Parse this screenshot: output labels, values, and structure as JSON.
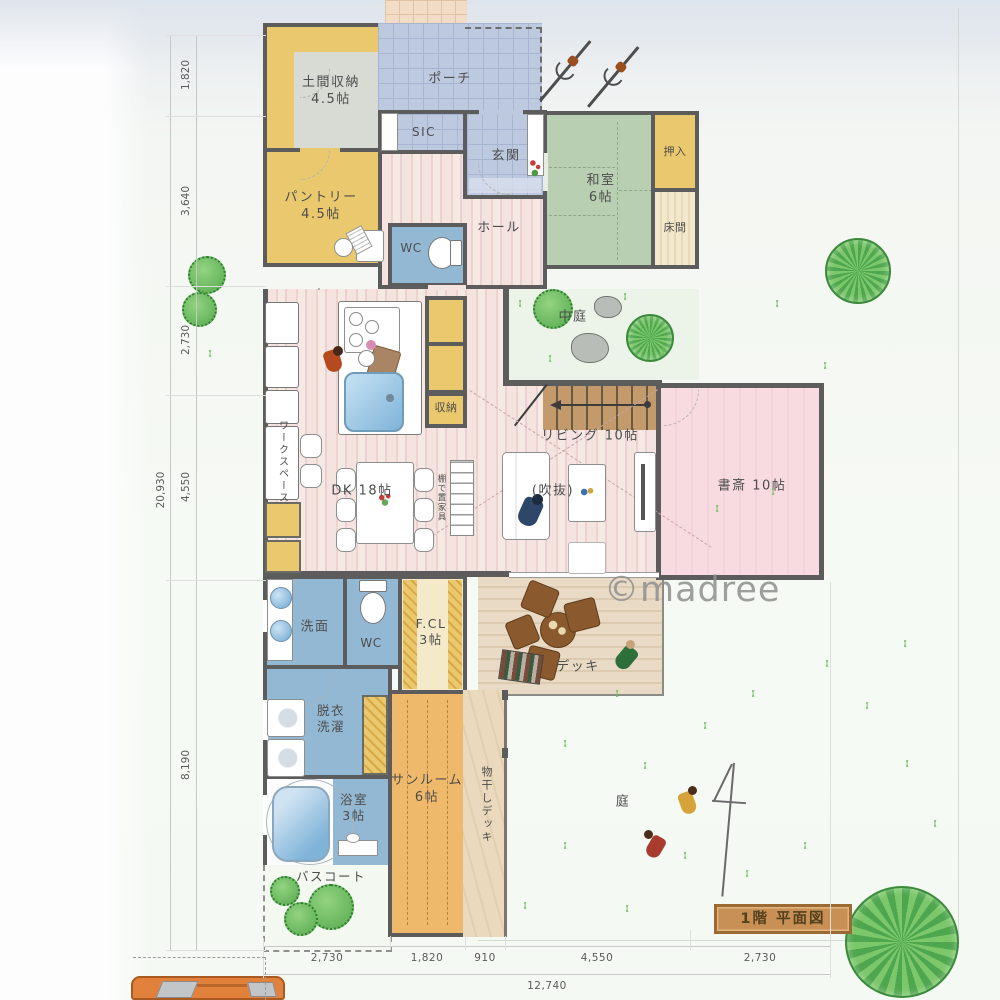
{
  "watermark": {
    "text": "©madree"
  },
  "sign": {
    "label": "1階 平面図"
  },
  "rooms": {
    "doma": {
      "label": "土間収納",
      "size": "4.5帖"
    },
    "pantry": {
      "label": "パントリー",
      "size": "4.5帖"
    },
    "porch": {
      "label": "ポーチ"
    },
    "sic": {
      "label": "SIC"
    },
    "genkan": {
      "label": "玄関"
    },
    "hall": {
      "label": "ホール"
    },
    "wc_upper": {
      "label": "WC"
    },
    "washitsu": {
      "label": "和室",
      "size": "6帖"
    },
    "oshiire": {
      "label": "押入"
    },
    "tokonoma": {
      "label": "床間"
    },
    "nakaniwa": {
      "label": "中庭"
    },
    "dk": {
      "label": "DK 18帖"
    },
    "shuno": {
      "label": "収納"
    },
    "workspace": {
      "label": "ワークスペース"
    },
    "living": {
      "label": "リビング 10帖"
    },
    "fukinuke": {
      "label": "(吹抜)"
    },
    "shelf_note": {
      "label": "棚で置家具"
    },
    "shosai": {
      "label": "書斎 10帖"
    },
    "senmen": {
      "label": "洗面"
    },
    "wc_lower": {
      "label": "WC"
    },
    "fcl": {
      "label": "F.CL",
      "size": "3帖"
    },
    "datsui_sentaku": {
      "label": "脱衣洗濯"
    },
    "sunroom": {
      "label": "サンルーム",
      "size": "6帖"
    },
    "monohoshi_deck": {
      "label": "物干しデッキ"
    },
    "bathroom": {
      "label": "浴室",
      "size": "3帖"
    },
    "bath_court": {
      "label": "バスコート"
    },
    "deck": {
      "label": "デッキ"
    },
    "niwa": {
      "label": "庭"
    }
  },
  "dimensions": {
    "left": [
      "1,820",
      "3,640",
      "2,730",
      "4,550",
      "8,190"
    ],
    "left_total": "20,930",
    "bottom": [
      "2,730",
      "1,820",
      "910",
      "4,550",
      "2,730"
    ],
    "bottom_total": "12,740"
  },
  "colors": {
    "wall": "#5d5c5c",
    "closet_yellow": "#eac86d",
    "tile_blue": "#bdc9de",
    "wet_blue": "#93b8d4",
    "tatami_green": "#b9cfb2",
    "floor_pink": "#f2e0dc",
    "study_pink": "#f7d8dd",
    "sunroom_orange": "#efb96b",
    "deck_wood": "#e6d7c1",
    "sign_wood": "#c89054"
  }
}
